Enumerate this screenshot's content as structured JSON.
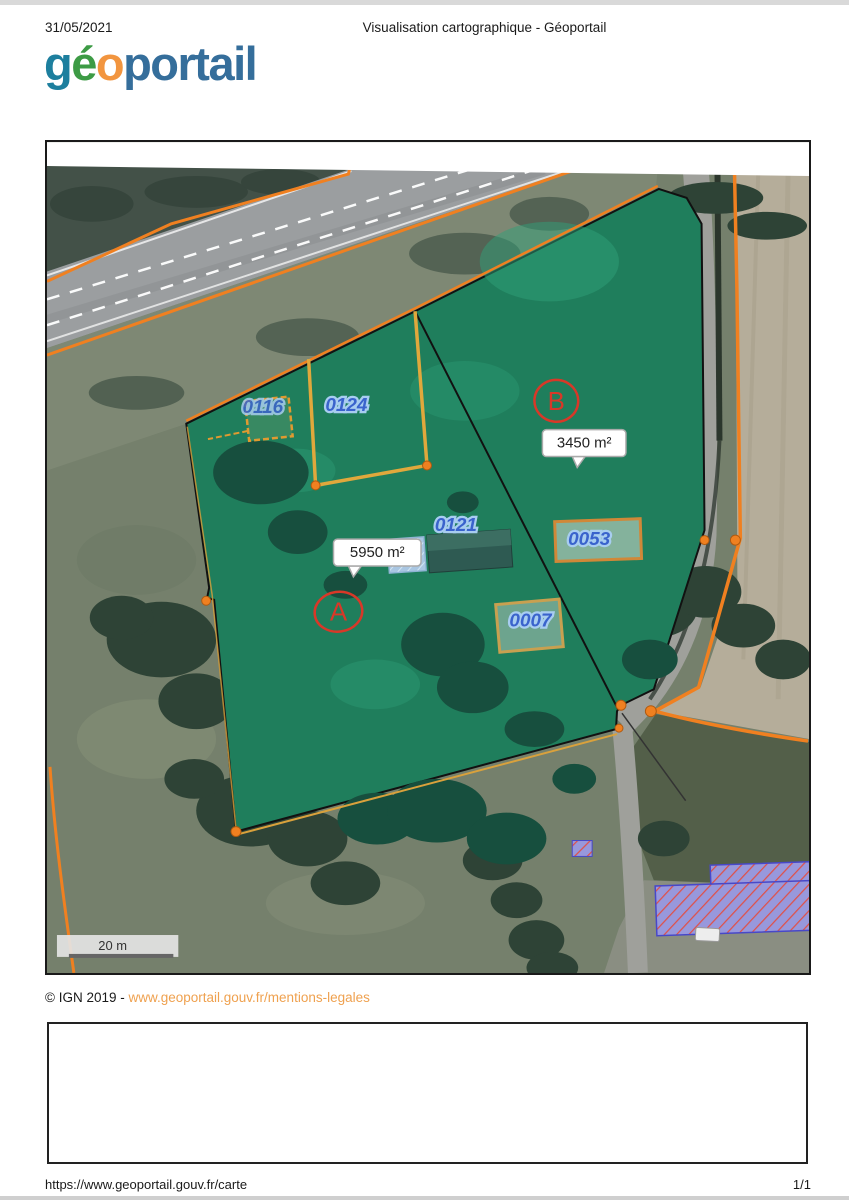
{
  "page": {
    "top_date": "31/05/2021",
    "doc_title": "Visualisation cartographique - Géoportail",
    "footer_url": "https://www.geoportail.gouv.fr/carte",
    "page_indicator": "1/1"
  },
  "logo": {
    "part_g": "g",
    "part_e": "é",
    "part_o": "o",
    "part_rest": "portail"
  },
  "attribution": {
    "copyright_prefix": "© IGN 2019 - ",
    "legal_link": "www.geoportail.gouv.fr/mentions-legales"
  },
  "map": {
    "scale_label": "20 m",
    "parcel_labels": {
      "p0116": "0116",
      "p0124": "0124",
      "p0121": "0121",
      "p0053": "0053",
      "p0007": "0007"
    },
    "zone_markers": {
      "zone_a": "A",
      "zone_b": "B"
    },
    "area_tooltips": {
      "zone_a": "5950 m²",
      "zone_b": "3450 m²"
    },
    "colors": {
      "parcel_overlay_green": "#1F7E5C",
      "cadastral_line_orange": "#F08020",
      "parcel_number_blue": "#3A63CC",
      "marker_red": "#D83828",
      "link_orange": "#EFA14F",
      "building_hatch_purple": "#9898DC",
      "building_hatch_red": "#E05048"
    }
  }
}
